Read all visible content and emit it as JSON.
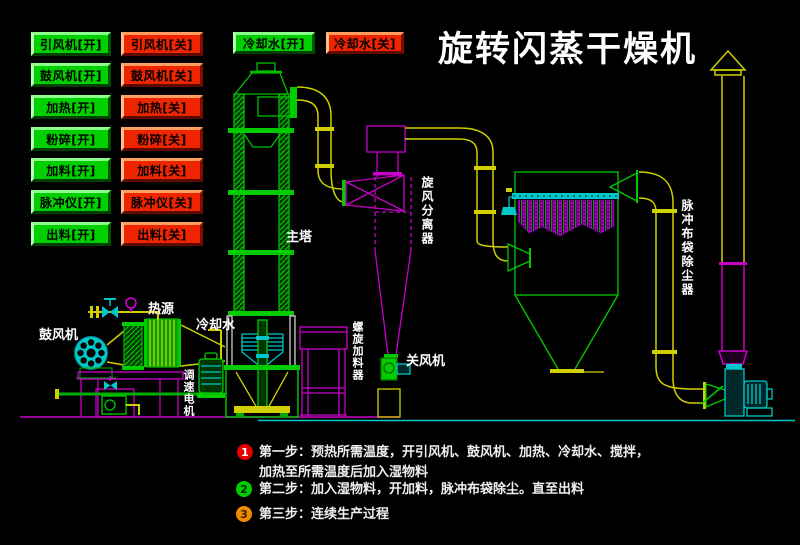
{
  "title": "旋转闪蒸干燥机",
  "panel": {
    "rows": [
      {
        "on": "引风机[开]",
        "off": "引风机[关]"
      },
      {
        "on": "鼓风机[开]",
        "off": "鼓风机[关]"
      },
      {
        "on": "加热[开]",
        "off": "加热[关]"
      },
      {
        "on": "粉碎[开]",
        "off": "粉碎[关]"
      },
      {
        "on": "加料[开]",
        "off": "加料[关]"
      },
      {
        "on": "脉冲仪[开]",
        "off": "脉冲仪[关]"
      },
      {
        "on": "出料[开]",
        "off": "出料[关]"
      }
    ],
    "cooling_on": "冷却水[开]",
    "cooling_off": "冷却水[关]"
  },
  "labels": {
    "main_tower": "主塔",
    "cyclone_separator": "旋风分离器",
    "bag_filter": "脉冲布袋除尘器",
    "blower": "鼓风机",
    "heat_source": "热源",
    "cooling_water": "冷却水",
    "speed_motor": "调速电机",
    "screw_feeder": "螺旋加料器",
    "rotary_valve": "关风机"
  },
  "steps": [
    {
      "num": "1",
      "line1": "第一步：预热所需温度，开引风机、鼓风机、加热、冷却水、搅拌，",
      "line2": "加热至所需温度后加入湿物料"
    },
    {
      "num": "2",
      "line1": "第二步：加入湿物料，开加料，脉冲布袋除尘。直至出料"
    },
    {
      "num": "3",
      "line1": "第三步：连续生产过程"
    }
  ],
  "colors": {
    "on_button": "#00cf00",
    "off_button": "#ee2500",
    "line_green": "#00c000",
    "line_yellow": "#d0d000",
    "line_magenta": "#c800c8",
    "line_cyan": "#00c8c8",
    "title_text": "#ffffff",
    "background": "#000000",
    "step1_badge": "#e00000",
    "step2_badge": "#00cc00",
    "step3_badge": "#f08800"
  }
}
